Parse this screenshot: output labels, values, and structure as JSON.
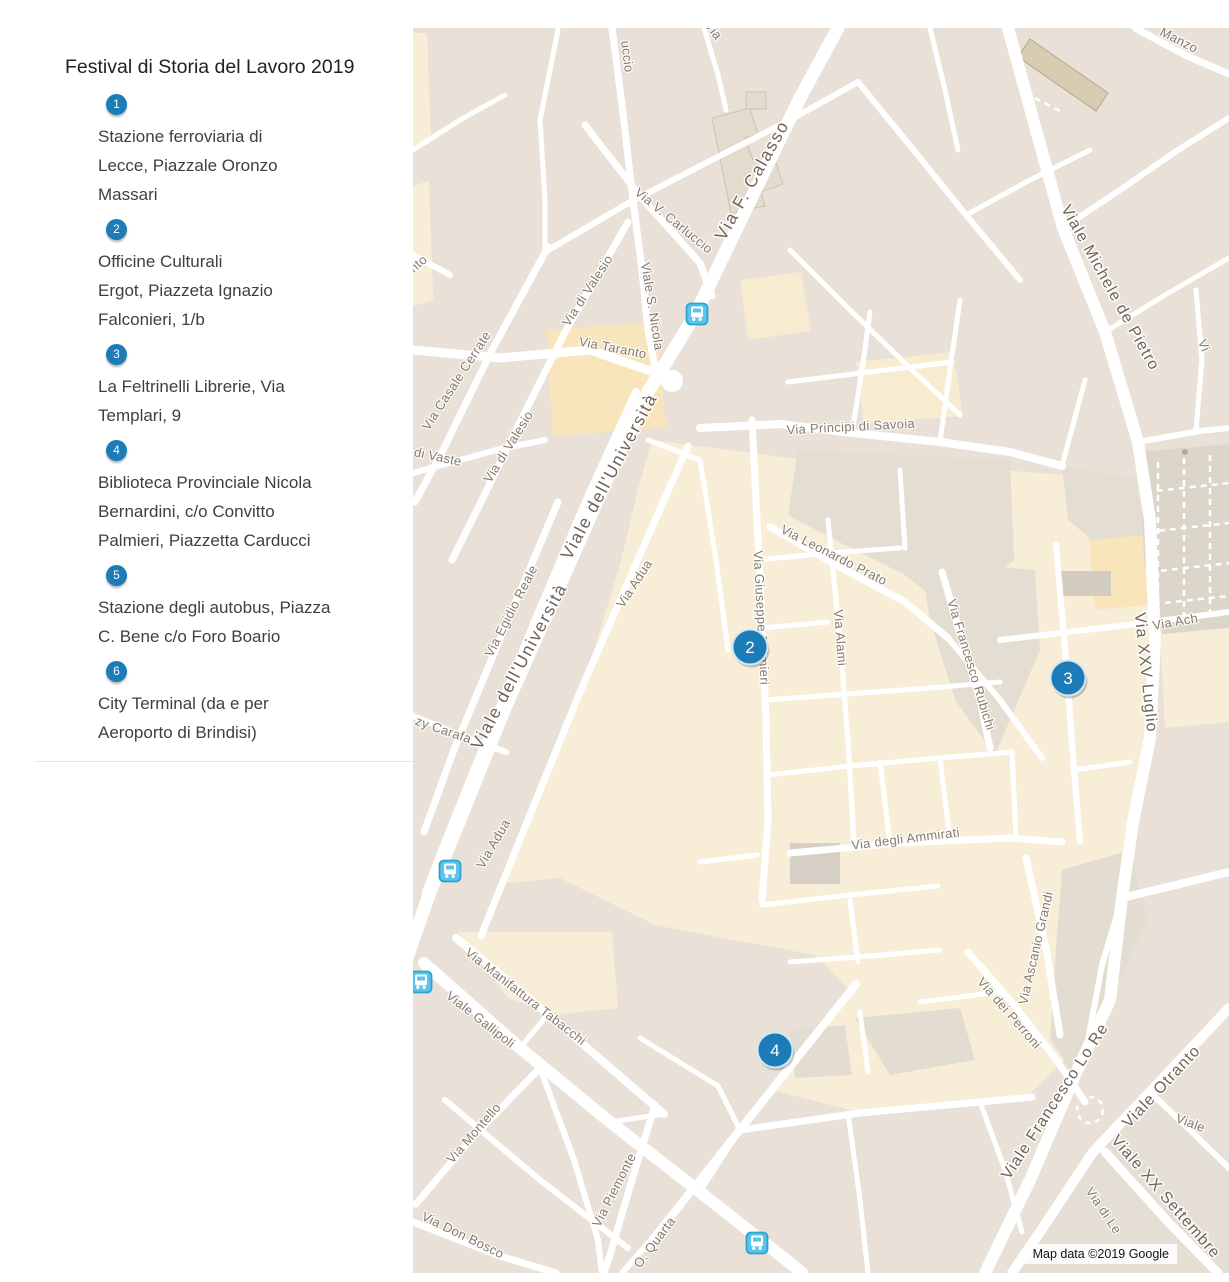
{
  "sidebar": {
    "title": "Festival di Storia del Lavoro 2019",
    "items": [
      {
        "number": "1",
        "lines": [
          "Stazione ferroviaria di",
          "Lecce, Piazzale Oronzo",
          "Massari"
        ]
      },
      {
        "number": "2",
        "lines": [
          "Officine Culturali",
          "Ergot, Piazzeta Ignazio",
          "Falconieri, 1/b"
        ]
      },
      {
        "number": "3",
        "lines": [
          "La Feltrinelli Librerie, Via",
          "Templari, 9"
        ]
      },
      {
        "number": "4",
        "lines": [
          "Biblioteca Provinciale Nicola",
          "Bernardini, c/o Convitto",
          "Palmieri, Piazzetta Carducci"
        ]
      },
      {
        "number": "5",
        "lines": [
          "Stazione degli autobus, Piazza",
          "C. Bene c/o Foro Boario"
        ]
      },
      {
        "number": "6",
        "lines": [
          "City Terminal (da e per",
          "Aeroporto di Brindisi)"
        ]
      }
    ]
  },
  "map": {
    "attribution": "Map data ©2019 Google",
    "colors": {
      "marker_blue": "#1d7cb7",
      "bus_teal": "#59c5ec",
      "bus_border": "#2fa3cd",
      "road_white": "#ffffff",
      "land_beige": "#e9e1d7",
      "old_town_cream": "#f8eed7",
      "label_grey": "#857b6f"
    },
    "markers": [
      {
        "number": "2",
        "x": 750,
        "y": 647
      },
      {
        "number": "3",
        "x": 1068,
        "y": 678
      },
      {
        "number": "4",
        "x": 775,
        "y": 1050
      }
    ],
    "bus_stops": [
      {
        "x": 697,
        "y": 314
      },
      {
        "x": 450,
        "y": 871
      },
      {
        "x": 421,
        "y": 982
      },
      {
        "x": 757,
        "y": 1243
      }
    ],
    "labels": [
      {
        "t": "Via F. Calasso",
        "x": 757,
        "y": 183,
        "r": -61,
        "s": "xl"
      },
      {
        "t": "Viale dell'Università",
        "x": 614,
        "y": 479,
        "r": -62,
        "s": "xl"
      },
      {
        "t": "Viale dell'Università",
        "x": 524,
        "y": 669,
        "r": -62,
        "s": "xl"
      },
      {
        "t": "Viale Michele de Pietro",
        "x": 1106,
        "y": 290,
        "r": 61,
        "s": "maj"
      },
      {
        "t": "Via XXV Luglio",
        "x": 1141,
        "y": 673,
        "r": 84,
        "s": "maj"
      },
      {
        "t": "Viale Francesco Lo Re",
        "x": 1059,
        "y": 1104,
        "r": -57,
        "s": "maj"
      },
      {
        "t": "Viale Otranto",
        "x": 1165,
        "y": 1090,
        "r": -47,
        "s": "maj"
      },
      {
        "t": "Viale XX Settembre",
        "x": 1162,
        "y": 1200,
        "r": 49,
        "s": "maj"
      },
      {
        "t": "uccio",
        "x": 623,
        "y": 57,
        "r": 83,
        "s": "min"
      },
      {
        "t": "Via",
        "x": 710,
        "y": 33,
        "r": 52,
        "s": "min"
      },
      {
        "t": "Via V. Carluccio",
        "x": 671,
        "y": 224,
        "r": 39,
        "s": "min"
      },
      {
        "t": "Viale S. Nicola",
        "x": 648,
        "y": 307,
        "r": 81,
        "s": "min"
      },
      {
        "t": "Via di Valesio",
        "x": 591,
        "y": 293,
        "r": -57,
        "s": "min"
      },
      {
        "t": "Via Taranto",
        "x": 612,
        "y": 352,
        "r": 11,
        "s": "min"
      },
      {
        "t": "Via Casale Cerrate",
        "x": 460,
        "y": 383,
        "r": -57,
        "s": "min"
      },
      {
        "t": "di Vaste",
        "x": 437,
        "y": 461,
        "r": 12,
        "s": "min"
      },
      {
        "t": "Via di Valesio",
        "x": 512,
        "y": 449,
        "r": -58,
        "s": "min"
      },
      {
        "t": "Via Egidio Reale",
        "x": 515,
        "y": 613,
        "r": -63,
        "s": "min"
      },
      {
        "t": "zy Carafa",
        "x": 442,
        "y": 734,
        "r": 19,
        "s": "min"
      },
      {
        "t": "Via Adua",
        "x": 638,
        "y": 586,
        "r": -57,
        "s": "min"
      },
      {
        "t": "Via Adua",
        "x": 497,
        "y": 846,
        "r": -60,
        "s": "min"
      },
      {
        "t": "Via Principi di Savoia",
        "x": 851,
        "y": 431,
        "r": -3,
        "s": "min"
      },
      {
        "t": "Via Leonardo Prato",
        "x": 832,
        "y": 559,
        "r": 27,
        "s": "min"
      },
      {
        "t": "Via Giuseppe Palmieri",
        "x": 757,
        "y": 618,
        "r": 87,
        "s": "min"
      },
      {
        "t": "Via Alami",
        "x": 836,
        "y": 638,
        "r": 86,
        "s": "min"
      },
      {
        "t": "Via Francesco Rubichi",
        "x": 967,
        "y": 666,
        "r": 73,
        "s": "min"
      },
      {
        "t": "Via Ach",
        "x": 1176,
        "y": 626,
        "r": -10,
        "s": "min"
      },
      {
        "t": "Manzo",
        "x": 1177,
        "y": 44,
        "r": 27,
        "s": "min"
      },
      {
        "t": "Vi",
        "x": 1200,
        "y": 347,
        "r": 68,
        "s": "min"
      },
      {
        "t": "Via degli Ammirati",
        "x": 906,
        "y": 843,
        "r": -7,
        "s": "min"
      },
      {
        "t": "Via dei Perroni",
        "x": 1006,
        "y": 1016,
        "r": 49,
        "s": "min"
      },
      {
        "t": "Via Ascanio Grandi",
        "x": 1040,
        "y": 949,
        "r": -77,
        "s": "min"
      },
      {
        "t": "Via Manifattura Tabacchi",
        "x": 523,
        "y": 1000,
        "r": 38,
        "s": "min"
      },
      {
        "t": "Viale Gallipoli",
        "x": 478,
        "y": 1023,
        "r": 38,
        "s": "min"
      },
      {
        "t": "Via Montello",
        "x": 477,
        "y": 1136,
        "r": -49,
        "s": "min"
      },
      {
        "t": "Via Don Bosco",
        "x": 461,
        "y": 1239,
        "r": 26,
        "s": "min"
      },
      {
        "t": "Via Piemonte",
        "x": 618,
        "y": 1192,
        "r": -63,
        "s": "min"
      },
      {
        "t": "O. Quarta",
        "x": 658,
        "y": 1245,
        "r": -53,
        "s": "min"
      },
      {
        "t": "Via di Le",
        "x": 1100,
        "y": 1213,
        "r": 56,
        "s": "min"
      },
      {
        "t": "Viale",
        "x": 1189,
        "y": 1127,
        "r": 21,
        "s": "min"
      },
      {
        "t": "nto",
        "x": 421,
        "y": 267,
        "r": -42,
        "s": "min"
      }
    ]
  }
}
